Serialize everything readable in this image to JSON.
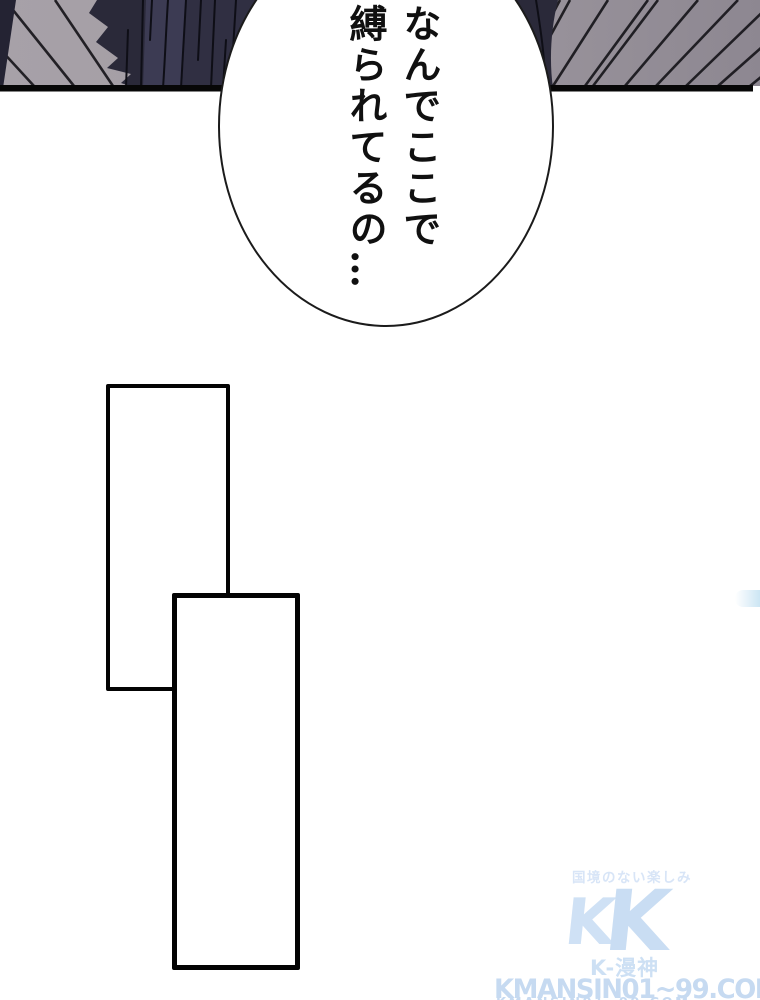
{
  "page": {
    "background": "#ffffff"
  },
  "top_panel": {
    "floor_color_left": "#a7a1a8",
    "floor_color_right": "#8d8791",
    "floor_line_color": "#17161b",
    "figure_color": "#2a2939",
    "figure_highlight_color": "#3c3b53",
    "figure_shade_color": "#302f42",
    "figure_fold_color": "#0e0e16",
    "wedge_color": "#242333",
    "border_color": "#070707"
  },
  "speech_bubble": {
    "fill": "#ffffff",
    "stroke": "#1b1b1b",
    "text_color": "#101010",
    "columns": [
      {
        "text": "なんでここで"
      },
      {
        "text": "縛られてるの…"
      }
    ]
  },
  "empty_panels": {
    "outline_color": "#030303",
    "fill": "#ffffff"
  },
  "watermark": {
    "color": "#cddff4",
    "tagline": "国境のない楽しみ",
    "tagline_color": "#d8e5f7",
    "logo_letter": "K",
    "logo_color_back": "#cfe1f5",
    "logo_color_front": "#c9ddf3",
    "brand": "K-漫神",
    "brand_color": "#cde0f4",
    "site": "KMANSIN01~99.COM",
    "site_color": "#c6daf1"
  }
}
